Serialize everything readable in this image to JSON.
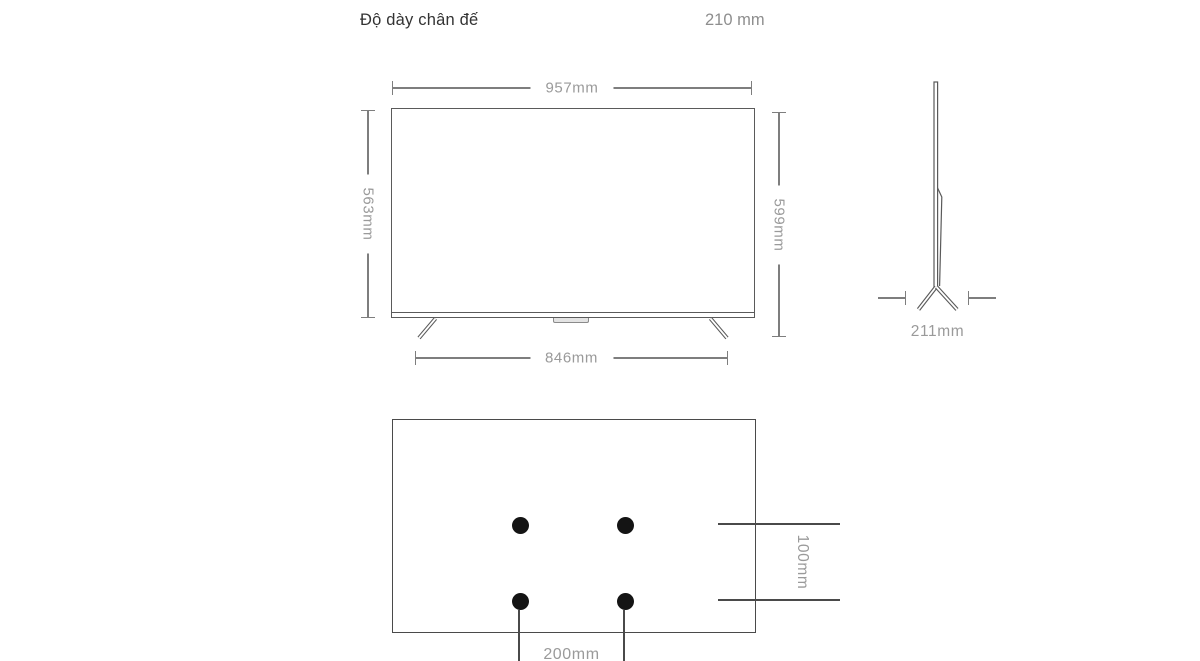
{
  "spec_row": {
    "label": "Độ dày chân đế",
    "value": "210 mm"
  },
  "diagram": {
    "front_view": {
      "description": "tv-front-dimension-drawing",
      "width_label": "957mm",
      "panel_height_label": "563mm",
      "total_height_label": "599mm",
      "stand_width_label": "846mm"
    },
    "side_view": {
      "description": "tv-side-profile-drawing",
      "base_depth_label": "211mm"
    },
    "back_view": {
      "description": "vesa-mount-hole-pattern",
      "hole_count": 4,
      "vertical_spacing_label": "100mm",
      "horizontal_spacing_label": "200mm"
    }
  },
  "colors": {
    "bg": "#ffffff",
    "heading_text": "#333333",
    "value_text": "#8e8e8e",
    "dim_text": "#9a9a9a",
    "dim_line": "#7e7e7e",
    "line": "#5a5a5a",
    "strong_line": "#4a4a4a",
    "hole_fill": "#141414"
  }
}
